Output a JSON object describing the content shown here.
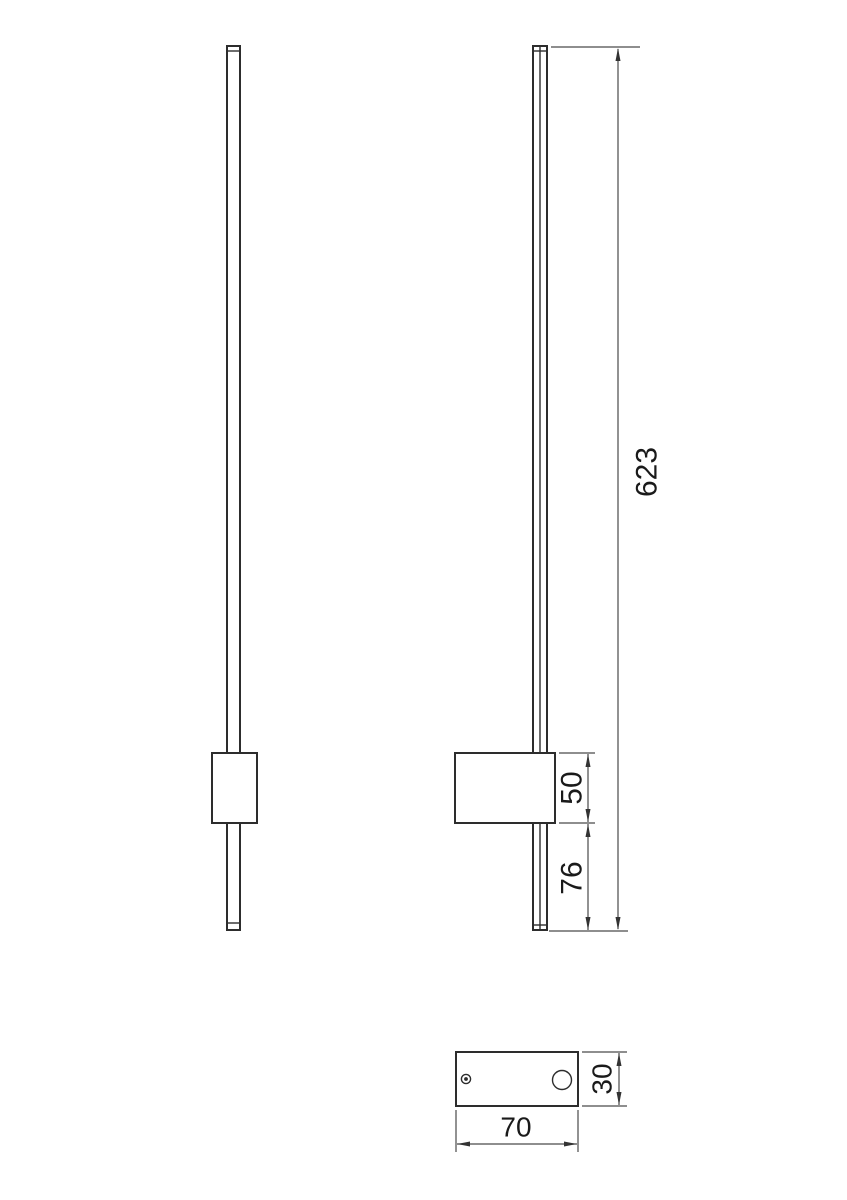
{
  "page": {
    "background": "#ffffff"
  },
  "drawing": {
    "type": "technical-dimension-drawing",
    "subject": "linear wall lamp shown in front view, side view and bottom (mounting plate) view",
    "colors": {
      "object_line": "#2d2d2d",
      "dimension_line": "#4a4a4a",
      "text": "#1a1a1a"
    },
    "dimensions": {
      "total_height": {
        "label": "623",
        "applies_to": "overall height of lamp bar, side view"
      },
      "mount_block_height": {
        "label": "50",
        "applies_to": "height of wall mount block, side view"
      },
      "below_block_length": {
        "label": "76",
        "applies_to": "bar length below mount block, side view"
      },
      "plate_depth": {
        "label": "30",
        "applies_to": "mounting plate depth, bottom view"
      },
      "plate_width": {
        "label": "70",
        "applies_to": "mounting plate width, bottom view"
      }
    }
  }
}
